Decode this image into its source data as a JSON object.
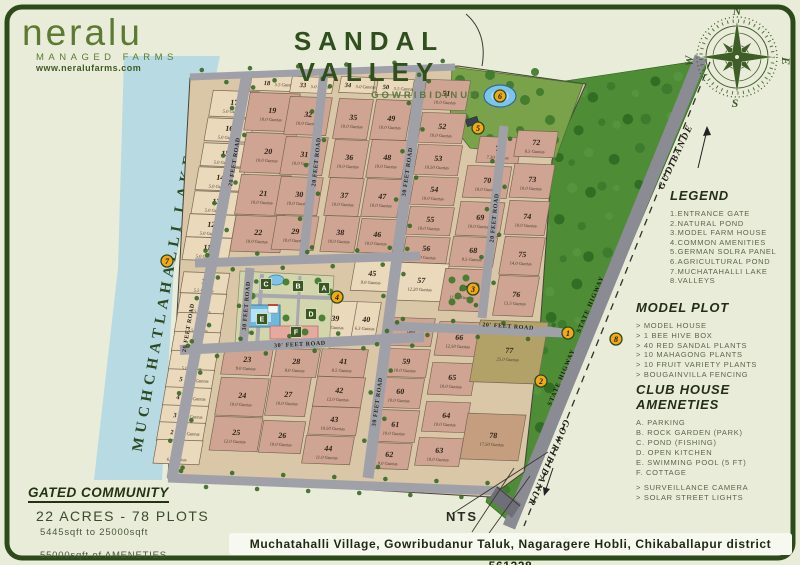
{
  "brand": {
    "name": "neralu",
    "tagline": "MANAGED FARMS",
    "website": "www.neralufarms.com"
  },
  "title": {
    "main": "SANDAL VALLEY",
    "sub": "GOWRIBIDINUR"
  },
  "compass": {
    "n": "N",
    "e": "E",
    "s": "S",
    "w": "W"
  },
  "legend": {
    "title": "LEGEND",
    "items": [
      "1.ENTRANCE GATE",
      "2.NATURAL POND",
      "3.MODEL FARM HOUSE",
      "4.COMMON AMENITIES",
      "5.GERMAN SOLRA PANEL",
      "6.AGRICULTURAL POND",
      "7.MUCHATAHALLI LAKE",
      "8.VALLEYS"
    ]
  },
  "model_plot": {
    "title": "MODEL PLOT",
    "items": [
      "> MODEL HOUSE",
      "> 1 BEE HIVE BOX",
      "> 40 RED SANDAL PLANTS",
      "> 10 MAHAGONG PLANTS",
      "> 10 FRUIT VARIETY PLANTS",
      "> BOUGAINVILLA FENCING"
    ]
  },
  "club_house": {
    "title": "CLUB HOUSE AMENETIES",
    "items": [
      "A. PARKING",
      "B. ROCK GARDEN (PARK)",
      "C. POND (FISHING)",
      "D. OPEN KITCHEN",
      "E. SWIMMING POOL (5 FT)",
      "F. COTTAGE"
    ],
    "extras": [
      "> SURVEILLANCE CAMERA",
      "> SOLAR STREET LIGHTS"
    ]
  },
  "stats": {
    "title": "GATED COMMUNITY",
    "line1": "22 ACRES - 78 PLOTS",
    "line2": "5445sqft to 25000sqft",
    "line3": "55000sqft of AMENETIES"
  },
  "footer": {
    "address": "Muchatahalli Village, Gowribudanur Taluk, Nagaragere Hobli, Chikaballapur district 561228"
  },
  "colors": {
    "border": "#2c4a1a",
    "lake": "#b8dae3",
    "park": "#79a24a",
    "forest": "#4e8c36",
    "road": "#a0a0a8",
    "highway": "#8b8b94",
    "marker": "#f3a818",
    "L": "#ead9bb",
    "R": "#cfa493",
    "O": "#b2a267",
    "T": "#c49e7e",
    "base": "#d9c7a7"
  },
  "map": {
    "lake_label": "MUCHCHATLAHALLI LAKE",
    "nts": "NTS",
    "roads": [
      {
        "x1": 247,
        "y1": 74,
        "x2": 172,
        "y2": 478,
        "w": 11
      },
      {
        "x1": 324,
        "y1": 72,
        "x2": 303,
        "y2": 260,
        "w": 9
      },
      {
        "x1": 422,
        "y1": 68,
        "x2": 368,
        "y2": 478,
        "w": 11
      },
      {
        "x1": 504,
        "y1": 126,
        "x2": 482,
        "y2": 318,
        "w": 9
      },
      {
        "x1": 195,
        "y1": 263,
        "x2": 420,
        "y2": 256,
        "w": 9
      },
      {
        "x1": 250,
        "y1": 268,
        "x2": 243,
        "y2": 345,
        "w": 9
      },
      {
        "x1": 180,
        "y1": 350,
        "x2": 424,
        "y2": 337,
        "w": 10
      },
      {
        "x1": 390,
        "y1": 326,
        "x2": 566,
        "y2": 333,
        "w": 9
      },
      {
        "x1": 168,
        "y1": 478,
        "x2": 500,
        "y2": 491,
        "w": 9
      },
      {
        "x1": 190,
        "y1": 77,
        "x2": 455,
        "y2": 67,
        "w": 7
      },
      {
        "x1": 566,
        "y1": 333,
        "x2": 544,
        "y2": 330,
        "w": 8
      },
      {
        "x1": 701,
        "y1": 57,
        "x2": 509,
        "y2": 527,
        "w": 13,
        "hwy": true
      }
    ],
    "road_labels": [
      {
        "text": "20 FEET ROAD",
        "x": 236,
        "y": 162,
        "r": -81
      },
      {
        "text": "20 FEET ROAD",
        "x": 190,
        "y": 328,
        "r": -80
      },
      {
        "text": "20 FEET ROAD",
        "x": 318,
        "y": 162,
        "r": -84
      },
      {
        "text": "30 FEET ROAD",
        "x": 409,
        "y": 172,
        "r": -82
      },
      {
        "text": "30 FEET ROAD",
        "x": 379,
        "y": 402,
        "r": -82
      },
      {
        "text": "20 FEET ROAD",
        "x": 496,
        "y": 218,
        "r": -84
      },
      {
        "text": "30 FEET ROAD",
        "x": 248,
        "y": 306,
        "r": -85
      },
      {
        "text": "30' FEET ROAD",
        "x": 300,
        "y": 346,
        "r": -3
      },
      {
        "text": "20' FEET ROAD",
        "x": 508,
        "y": 328,
        "r": 4
      }
    ],
    "highway_labels": [
      {
        "text": "STATE HIGWAY",
        "x": 592,
        "y": 305,
        "r": -67
      },
      {
        "text": "STATE HIGWAY",
        "x": 563,
        "y": 378,
        "r": -67
      }
    ],
    "direction_labels": [
      {
        "text": "GUDIBANDE",
        "x": 678,
        "y": 158,
        "r": -65
      },
      {
        "text": "GOWRIBIDANUR",
        "x": 546,
        "y": 462,
        "r": 113
      }
    ],
    "markers": [
      {
        "n": "1",
        "x": 568,
        "y": 333
      },
      {
        "n": "2",
        "x": 541,
        "y": 381
      },
      {
        "n": "3",
        "x": 473,
        "y": 289
      },
      {
        "n": "4",
        "x": 337,
        "y": 297
      },
      {
        "n": "5",
        "x": 478,
        "y": 128
      },
      {
        "n": "6",
        "x": 500,
        "y": 96
      },
      {
        "n": "7",
        "x": 167,
        "y": 261
      },
      {
        "n": "8",
        "x": 616,
        "y": 339
      }
    ],
    "amenity_labels": [
      {
        "l": "A",
        "x": 324,
        "y": 288
      },
      {
        "l": "B",
        "x": 298,
        "y": 286
      },
      {
        "l": "C",
        "x": 266,
        "y": 284
      },
      {
        "l": "D",
        "x": 311,
        "y": 314
      },
      {
        "l": "E",
        "x": 262,
        "y": 319
      },
      {
        "l": "F",
        "x": 296,
        "y": 332
      }
    ],
    "plots": [
      {
        "n": "17",
        "g": "5.0 Guntas",
        "x": 234,
        "y": 104,
        "w": 46,
        "h": 26,
        "c": "L"
      },
      {
        "n": "16",
        "g": "5.0 Guntas",
        "x": 229,
        "y": 130,
        "w": 46,
        "h": 23,
        "c": "L"
      },
      {
        "n": "15",
        "g": "5.0 Guntas",
        "x": 225,
        "y": 155,
        "w": 46,
        "h": 23,
        "c": "L"
      },
      {
        "n": "14",
        "g": "5.0 Guntas",
        "x": 220,
        "y": 179,
        "w": 46,
        "h": 23,
        "c": "L"
      },
      {
        "n": "13",
        "g": "5.0 Guntas",
        "x": 216,
        "y": 203,
        "w": 46,
        "h": 23,
        "c": "L"
      },
      {
        "n": "12",
        "g": "5.0 Guntas",
        "x": 211,
        "y": 226,
        "w": 46,
        "h": 23,
        "c": "L"
      },
      {
        "n": "11",
        "g": "5.0 Guntas",
        "x": 207,
        "y": 249,
        "w": 46,
        "h": 23,
        "c": "L"
      },
      {
        "n": "10",
        "g": "5.5 Guntas",
        "x": 205,
        "y": 283,
        "w": 46,
        "h": 21,
        "c": "L"
      },
      {
        "n": "9",
        "g": "5.5 Guntas",
        "x": 202,
        "y": 304,
        "w": 46,
        "h": 21,
        "c": "L"
      },
      {
        "n": "8",
        "g": "5.5 Guntas",
        "x": 199,
        "y": 323,
        "w": 46,
        "h": 20,
        "c": "L"
      },
      {
        "n": "7",
        "g": "5.5 Guntas",
        "x": 196,
        "y": 342,
        "w": 46,
        "h": 20,
        "c": "L"
      },
      {
        "n": "6",
        "g": "5.0 Guntas",
        "x": 193,
        "y": 361,
        "w": 46,
        "h": 20,
        "c": "L"
      },
      {
        "n": "5",
        "g": "5.0 Guntas",
        "x": 190,
        "y": 379,
        "w": 46,
        "h": 19,
        "c": "L"
      },
      {
        "n": "4",
        "g": "5.0 Guntas",
        "x": 187,
        "y": 397,
        "w": 46,
        "h": 19,
        "c": "L"
      },
      {
        "n": "3",
        "g": "5.0 Guntas",
        "x": 184,
        "y": 415,
        "w": 46,
        "h": 19,
        "c": "L"
      },
      {
        "n": "2",
        "g": "5.0 Guntas",
        "x": 181,
        "y": 432,
        "w": 46,
        "h": 19,
        "c": "L"
      },
      {
        "n": "1",
        "g": "6.5 Guntas",
        "x": 178,
        "y": 452,
        "w": 46,
        "h": 24,
        "c": "L"
      },
      {
        "n": "18",
        "g": "5.5 Guntas",
        "x": 276,
        "y": 83,
        "w": 50,
        "h": 16,
        "c": "L"
      },
      {
        "n": "19",
        "g": "10.0 Guntas",
        "x": 272,
        "y": 112,
        "w": 50,
        "h": 38,
        "c": "R"
      },
      {
        "n": "20",
        "g": "10.0 Guntas",
        "x": 268,
        "y": 153,
        "w": 50,
        "h": 40,
        "c": "R"
      },
      {
        "n": "21",
        "g": "10.0 Guntas",
        "x": 263,
        "y": 195,
        "w": 50,
        "h": 40,
        "c": "R"
      },
      {
        "n": "22",
        "g": "10.0 Guntas",
        "x": 258,
        "y": 234,
        "w": 50,
        "h": 36,
        "c": "R"
      },
      {
        "n": "33",
        "g": "5.0 Guntas",
        "x": 312,
        "y": 85,
        "w": 42,
        "h": 16,
        "c": "L"
      },
      {
        "n": "32",
        "g": "10.0 Guntas",
        "x": 308,
        "y": 116,
        "w": 42,
        "h": 38,
        "c": "R"
      },
      {
        "n": "31",
        "g": "10.0 Guntas",
        "x": 304,
        "y": 156,
        "w": 42,
        "h": 38,
        "c": "R"
      },
      {
        "n": "30",
        "g": "10.0 Guntas",
        "x": 299,
        "y": 196,
        "w": 42,
        "h": 38,
        "c": "R"
      },
      {
        "n": "29",
        "g": "10.0 Guntas",
        "x": 295,
        "y": 233,
        "w": 42,
        "h": 34,
        "c": "R"
      },
      {
        "n": "34",
        "g": "5.0 Guntas",
        "x": 357,
        "y": 85,
        "w": 34,
        "h": 16,
        "c": "L"
      },
      {
        "n": "35",
        "g": "10.0 Guntas",
        "x": 353,
        "y": 119,
        "w": 34,
        "h": 40,
        "c": "R"
      },
      {
        "n": "36",
        "g": "10.0 Guntas",
        "x": 349,
        "y": 159,
        "w": 34,
        "h": 38,
        "c": "R"
      },
      {
        "n": "37",
        "g": "10.0 Guntas",
        "x": 344,
        "y": 197,
        "w": 34,
        "h": 38,
        "c": "R"
      },
      {
        "n": "38",
        "g": "10.0 Guntas",
        "x": 340,
        "y": 234,
        "w": 34,
        "h": 36,
        "c": "R"
      },
      {
        "n": "50",
        "g": "5.5 Guntas",
        "x": 395,
        "y": 87,
        "w": 36,
        "h": 16,
        "c": "L"
      },
      {
        "n": "49",
        "g": "10.0 Guntas",
        "x": 391,
        "y": 120,
        "w": 36,
        "h": 40,
        "c": "R"
      },
      {
        "n": "48",
        "g": "10.0 Guntas",
        "x": 387,
        "y": 159,
        "w": 36,
        "h": 38,
        "c": "R"
      },
      {
        "n": "47",
        "g": "10.0 Guntas",
        "x": 382,
        "y": 198,
        "w": 36,
        "h": 38,
        "c": "R"
      },
      {
        "n": "46",
        "g": "10.0 Guntas",
        "x": 377,
        "y": 236,
        "w": 36,
        "h": 34,
        "c": "R"
      },
      {
        "n": "51",
        "g": "10.0 Guntas",
        "x": 446,
        "y": 95,
        "w": 44,
        "h": 30,
        "c": "R"
      },
      {
        "n": "52",
        "g": "10.0 Guntas",
        "x": 442,
        "y": 128,
        "w": 44,
        "h": 30,
        "c": "R"
      },
      {
        "n": "53",
        "g": "10.50 Guntas",
        "x": 438,
        "y": 160,
        "w": 44,
        "h": 30,
        "c": "R"
      },
      {
        "n": "54",
        "g": "10.0 Guntas",
        "x": 434,
        "y": 191,
        "w": 44,
        "h": 28,
        "c": "R"
      },
      {
        "n": "55",
        "g": "10.0 Guntas",
        "x": 430,
        "y": 221,
        "w": 44,
        "h": 28,
        "c": "R"
      },
      {
        "n": "56",
        "g": "10.0 Guntas",
        "x": 426,
        "y": 250,
        "w": 44,
        "h": 26,
        "c": "R"
      },
      {
        "n": "71",
        "g": "7.30 Guntas",
        "x": 499,
        "y": 150,
        "w": 42,
        "h": 26,
        "c": "R"
      },
      {
        "n": "70",
        "g": "10.0 Guntas",
        "x": 487,
        "y": 182,
        "w": 44,
        "h": 32,
        "c": "R"
      },
      {
        "n": "69",
        "g": "10.0 Guntas",
        "x": 480,
        "y": 219,
        "w": 44,
        "h": 34,
        "c": "R"
      },
      {
        "n": "68",
        "g": "9.5 Guntas",
        "x": 473,
        "y": 252,
        "w": 44,
        "h": 30,
        "c": "R"
      },
      {
        "n": "72",
        "g": "8.5 Guntas",
        "x": 536,
        "y": 144,
        "w": 40,
        "h": 26,
        "c": "R"
      },
      {
        "n": "73",
        "g": "10.0 Guntas",
        "x": 532,
        "y": 181,
        "w": 40,
        "h": 34,
        "c": "R"
      },
      {
        "n": "74",
        "g": "10.0 Guntas",
        "x": 527,
        "y": 218,
        "w": 40,
        "h": 34,
        "c": "R"
      },
      {
        "n": "75",
        "g": "14.0 Guntas",
        "x": 522,
        "y": 256,
        "w": 40,
        "h": 38,
        "c": "R"
      },
      {
        "n": "76",
        "g": "13.5 Guntas",
        "x": 516,
        "y": 296,
        "w": 40,
        "h": 40,
        "c": "R"
      },
      {
        "n": "45",
        "g": "9.0 Guntas",
        "x": 372,
        "y": 275,
        "w": 38,
        "h": 32,
        "c": "L"
      },
      {
        "n": "57",
        "g": "12.20 Guntas",
        "x": 421,
        "y": 282,
        "w": 50,
        "h": 38,
        "c": "L"
      },
      {
        "n": "39",
        "g": "7.0 Guntas",
        "x": 335,
        "y": 320,
        "w": 40,
        "h": 38,
        "c": "L"
      },
      {
        "n": "40",
        "g": "6.3 Guntas",
        "x": 366,
        "y": 321,
        "w": 24,
        "h": 38,
        "c": "L"
      },
      {
        "n": "67",
        "g": "11.50 Guntas",
        "x": 463,
        "y": 290,
        "w": 42,
        "h": 42,
        "c": "R"
      },
      {
        "n": "23",
        "g": "9.0 Guntas",
        "x": 247,
        "y": 361,
        "w": 48,
        "h": 28,
        "c": "R"
      },
      {
        "n": "24",
        "g": "10.0 Guntas",
        "x": 242,
        "y": 397,
        "w": 48,
        "h": 38,
        "c": "R"
      },
      {
        "n": "25",
        "g": "12.0 Guntas",
        "x": 236,
        "y": 434,
        "w": 48,
        "h": 34,
        "c": "R"
      },
      {
        "n": "27",
        "g": "10.0 Guntas",
        "x": 288,
        "y": 396,
        "w": 40,
        "h": 40,
        "c": "R"
      },
      {
        "n": "26",
        "g": "10.0 Guntas",
        "x": 282,
        "y": 437,
        "w": 42,
        "h": 32,
        "c": "R"
      },
      {
        "n": "28",
        "g": "8.0 Guntas",
        "x": 296,
        "y": 363,
        "w": 44,
        "h": 28,
        "c": "R"
      },
      {
        "n": "41",
        "g": "8.5 Guntas",
        "x": 343,
        "y": 363,
        "w": 46,
        "h": 28,
        "c": "R"
      },
      {
        "n": "42",
        "g": "12.0 Guntas",
        "x": 339,
        "y": 392,
        "w": 48,
        "h": 30,
        "c": "R"
      },
      {
        "n": "43",
        "g": "10.50 Guntas",
        "x": 334,
        "y": 421,
        "w": 48,
        "h": 28,
        "c": "R"
      },
      {
        "n": "44",
        "g": "11.0 Guntas",
        "x": 328,
        "y": 450,
        "w": 48,
        "h": 28,
        "c": "R"
      },
      {
        "n": "58",
        "g": "10.0 Guntas",
        "x": 411,
        "y": 332,
        "w": 44,
        "h": 28,
        "c": "R"
      },
      {
        "n": "59",
        "g": "10.0 Guntas",
        "x": 406,
        "y": 363,
        "w": 44,
        "h": 28,
        "c": "R"
      },
      {
        "n": "60",
        "g": "10.0 Guntas",
        "x": 400,
        "y": 393,
        "w": 44,
        "h": 30,
        "c": "R"
      },
      {
        "n": "61",
        "g": "10.0 Guntas",
        "x": 395,
        "y": 426,
        "w": 44,
        "h": 32,
        "c": "R"
      },
      {
        "n": "62",
        "g": "9.0 Guntas",
        "x": 389,
        "y": 456,
        "w": 42,
        "h": 26,
        "c": "R"
      },
      {
        "n": "66",
        "g": "12.50 Guntas",
        "x": 459,
        "y": 339,
        "w": 44,
        "h": 34,
        "c": "R"
      },
      {
        "n": "65",
        "g": "10.0 Guntas",
        "x": 452,
        "y": 379,
        "w": 44,
        "h": 32,
        "c": "R"
      },
      {
        "n": "64",
        "g": "10.0 Guntas",
        "x": 446,
        "y": 417,
        "w": 44,
        "h": 30,
        "c": "R"
      },
      {
        "n": "63",
        "g": "10.0 Guntas",
        "x": 439,
        "y": 452,
        "w": 44,
        "h": 28,
        "c": "R"
      },
      {
        "n": "77",
        "g": "25.0 Guntas",
        "x": 509,
        "y": 352,
        "w": 68,
        "h": 62,
        "c": "O"
      },
      {
        "n": "78",
        "g": "17.50 Guntas",
        "x": 493,
        "y": 437,
        "w": 58,
        "h": 46,
        "c": "T"
      }
    ]
  }
}
